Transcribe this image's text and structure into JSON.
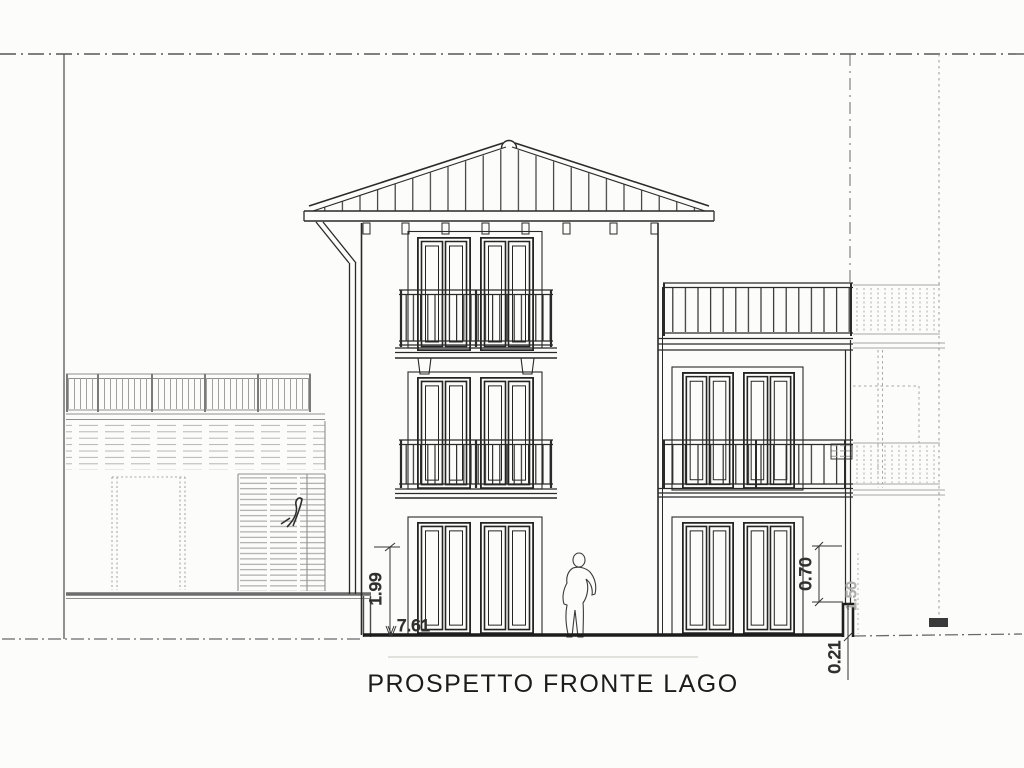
{
  "drawing": {
    "title": "PROSPETTO FRONTE LAGO",
    "dimension_labels": {
      "height_left": "1.99",
      "width_bottom": "7.61",
      "parapet_right": "0.70",
      "setback_right_faint": "1.50",
      "curb_right": "0.21"
    },
    "scale_figure": "standing-person-outline",
    "colors": {
      "ink": "#262626",
      "ink_light": "#969696",
      "paper": "#fcfcfa"
    }
  }
}
